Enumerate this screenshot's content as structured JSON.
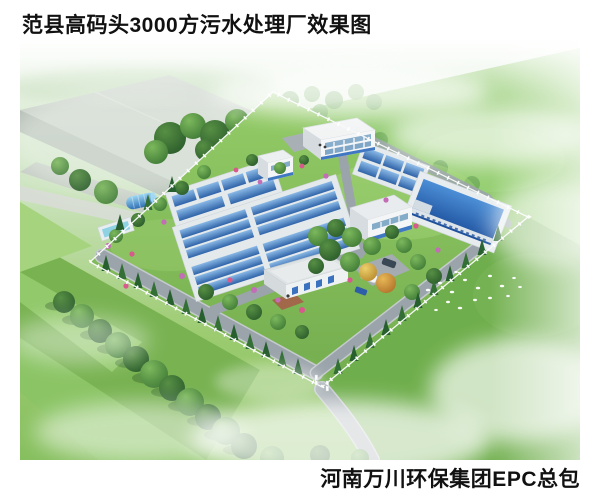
{
  "header": {
    "title": "范县高码头3000方污水处理厂效果图"
  },
  "footer": {
    "credit": "河南万川环保集团EPC总包"
  },
  "scene": {
    "subject": "sewage-treatment-plant-aerial-rendering",
    "palette": {
      "pool_blue": "#3a71b8",
      "deep_pool_blue": "#1d4f9c",
      "pool_rim_white": "#e4e9ec",
      "lawn_green": "#82bd57",
      "field_green": "#78b251",
      "road_gray": "#9ba4ab",
      "building_white": "#f3f5f6",
      "accent_blue": "#3f77c2",
      "tree_green": "#35682f",
      "flower_pink": "#c06ab0",
      "mist_white": "#ffffff",
      "text_black": "#111111",
      "background": "#ffffff"
    }
  }
}
